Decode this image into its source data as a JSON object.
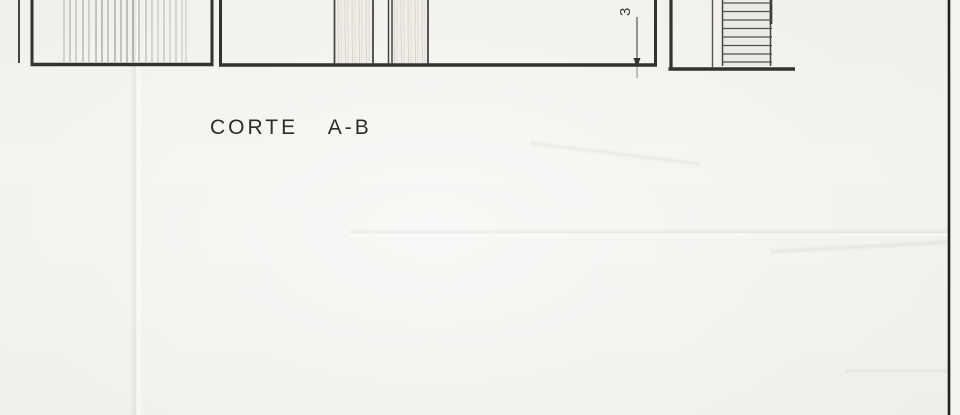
{
  "drawing": {
    "title": "CORTE A-B",
    "dimension_label": "3",
    "colors": {
      "paper": "#f1f0ec",
      "ink": "#34322d",
      "ink_soft": "#55534c",
      "hatch": "#4a4843",
      "sheet_edge_line": "#23211e"
    }
  }
}
